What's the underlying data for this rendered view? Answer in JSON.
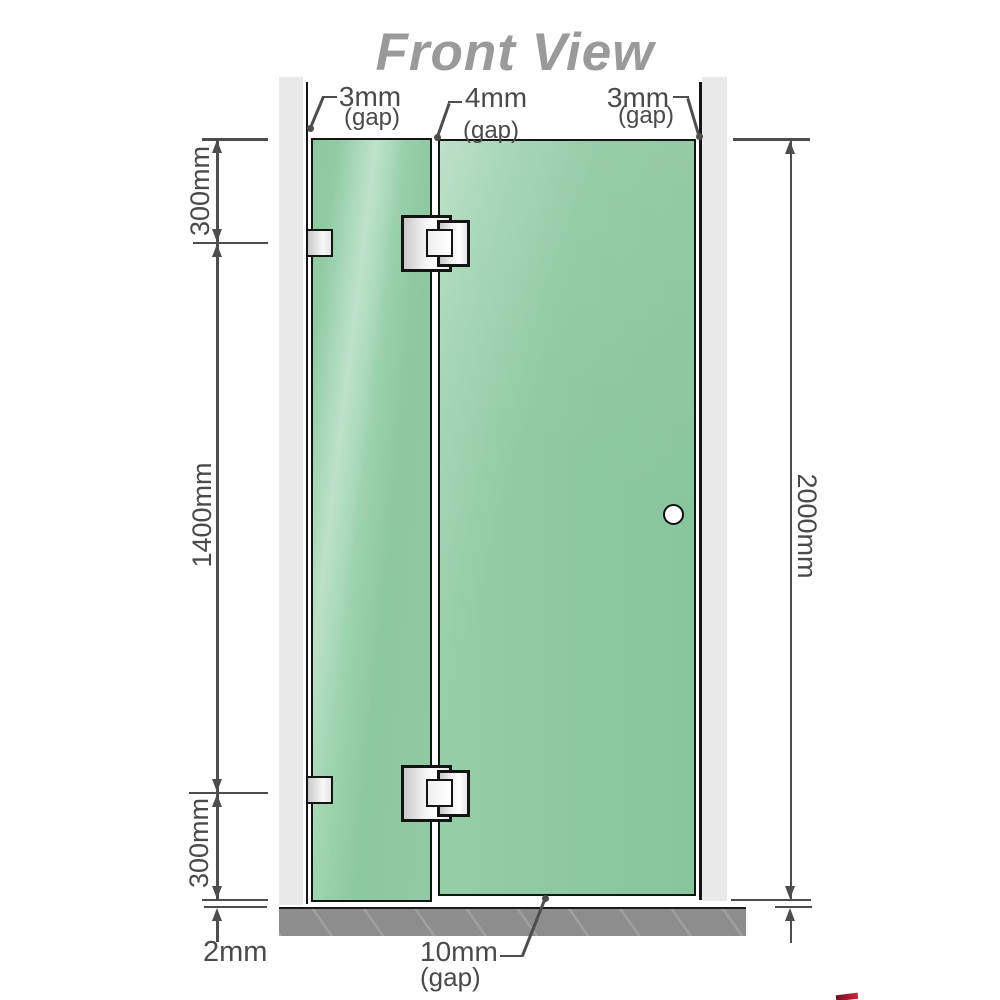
{
  "title": "Front View",
  "top_gap_labels": {
    "left": {
      "value": "3mm",
      "unit": "(gap)"
    },
    "middle": {
      "value": "4mm",
      "unit": "(gap)"
    },
    "right": {
      "value": "3mm",
      "unit": "(gap)"
    }
  },
  "side_dimensions": {
    "left_top": "300mm",
    "left_middle": "1400mm",
    "left_bottom": "300mm",
    "right_full_height": "2000mm"
  },
  "bottom_dimensions": {
    "floor_offset": "2mm",
    "door_floor_gap_value": "10mm",
    "door_floor_gap_unit": "(gap)"
  },
  "colors": {
    "glass_green": "#8fcaa3",
    "wall_gray": "#e9e9e9",
    "floor_gray": "#8d8d8d",
    "dimension_gray": "#4a4a4a",
    "outline_black": "#141414",
    "title_gray": "#9a9a9a",
    "logo_red": "#c0273b"
  }
}
